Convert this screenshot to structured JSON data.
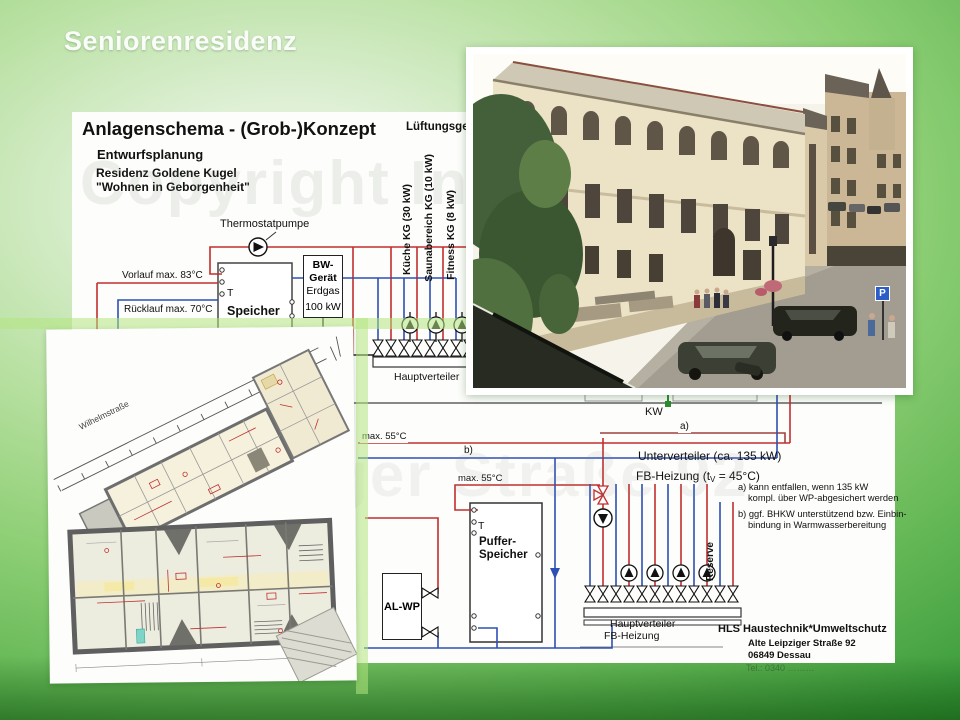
{
  "slide": {
    "title": "Seniorenresidenz"
  },
  "watermark": {
    "line1": "Copyright Infor",
    "line2": "ger Straße 92"
  },
  "schematic": {
    "heading": "Anlagenschema - (Grob-)Konzept",
    "subheading": "Entwurfsplanung",
    "project_line1": "Residenz Goldene Kugel",
    "project_line2": "\"Wohnen in Geborgenheit\"",
    "labels": {
      "lueftungsgeraet": "Lüftungsgerät",
      "kueche": "Küche KG (30 kW)",
      "sauna": "Saunabereich KG (10 kW)",
      "fitness": "Fitness KG (8 kW)",
      "thermostatpumpe": "Thermostatpumpe",
      "vorlauf": "Vorlauf max. 83°C",
      "ruecklauf": "Rücklauf max. 70°C",
      "t_sensor1": "T",
      "speicher": "Speicher",
      "bw1": "BW-",
      "bw2": "Gerät",
      "bw3": "Erdgas",
      "bw4": "100 kW",
      "hauptverteiler": "Hauptverteiler",
      "kw": "KW",
      "a_marker": "a)",
      "b_marker": "b)",
      "max55_1": "max. 55°C",
      "max55_2": "max. 55°C",
      "unterverteiler": "Unterverteiler (ca. 135 kW)",
      "fb_pre": "FB-Heizung  (t",
      "fb_sub": "V",
      "fb_post": " = 45°C)",
      "t_sensor2": "T",
      "puffer1": "Puffer-",
      "puffer2": "Speicher",
      "alwp": "AL-WP",
      "reserve": "Reserve",
      "hv_fb1": "Hauptverteiler",
      "hv_fb2": "FB-Heizung"
    },
    "notes": {
      "a1": "a) kann entfallen, wenn 135 kW",
      "a2": "kompl. über WP-abgesichert werden",
      "b1": "b) ggf. BHKW unterstützend bzw. Einbin-",
      "b2": "bindung in Warmwasserbereitung"
    },
    "company": {
      "name": "HLS Haustechnik*Umweltschutz",
      "street": "Alte Leipziger Straße 92",
      "city": "06849 Dessau",
      "phone_faint": "Tel.: 0340 ………"
    }
  },
  "floorplan": {
    "street_label": "Wilhelmstraße"
  },
  "photo": {
    "parking_sign": "P"
  },
  "colors": {
    "pipe_red": "#c22e2e",
    "pipe_blue": "#2e50b4",
    "pipe_gray": "#777777",
    "accent_green": "#2e8b2e",
    "background_green": "#3c9c3c"
  }
}
